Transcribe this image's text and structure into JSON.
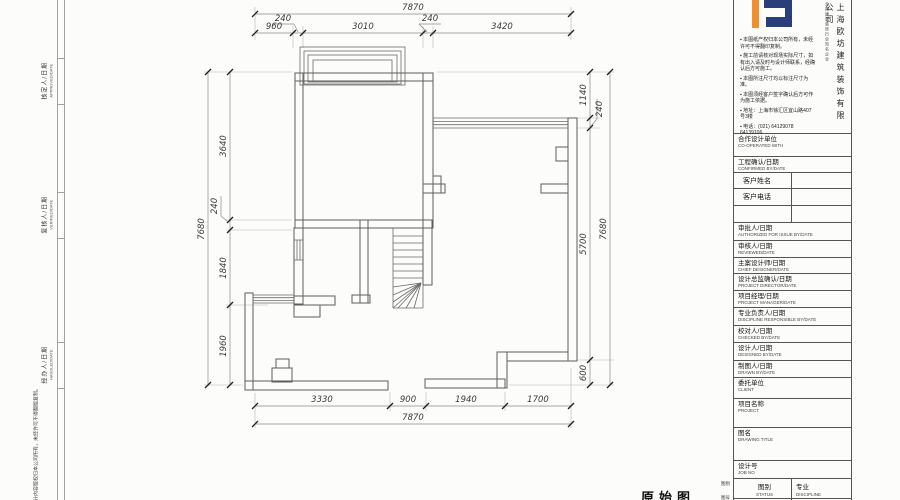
{
  "drawing": {
    "caption": "原始图"
  },
  "border": {
    "labels": [
      {
        "cn": "核定人/日期",
        "en": "APPROVED/DATE"
      },
      {
        "cn": "复核人/日期",
        "en": "VERIFIED/DATE"
      },
      {
        "cn": "经办人/日期",
        "en": "HANDLED/DATE"
      }
    ],
    "copyright": "本图纸设计内容版权归本公司所有，未经许可不得翻版复制。",
    "outside_labels": [
      "图别",
      "图号"
    ]
  },
  "titleblock": {
    "company": "上海欧坊建筑装饰有限公司",
    "tagline": "全国建筑装饰行业知名企业",
    "brand_navy": "#2b3e7c",
    "brand_orange": "#ef8f2f",
    "notes": [
      "▪ 本图纸产权归本公司所有，未经许可不得翻印复制。",
      "▪ 施工前请核对现场实际尺寸，如有出入请及时与设计师联系，经确认后方可施工。",
      "▪ 本图所注尺寸均以标注尺寸为准。",
      "▪ 本图须经客户签字确认后方可作为施工依据。",
      "▪ 地址：上海市徐汇区宜山路407号3楼",
      "▪ 电话：(021) 64129078  64139106"
    ],
    "rows": [
      {
        "cn": "合作设计单位",
        "en": "CO-OPERATED WITH"
      },
      {
        "cn": "工程确认/日期",
        "en": "CONFIRMED BY/DATE"
      },
      {
        "cn": "客户姓名",
        "en": ""
      },
      {
        "cn": "客户电话",
        "en": ""
      },
      {
        "cn": "",
        "en": ""
      },
      {
        "cn": "审批人/日期",
        "en": "AUTHORIZED FOR ISSUE BY/DATE"
      },
      {
        "cn": "审核人/日期",
        "en": "REVIEWED/DATE"
      },
      {
        "cn": "主案设计师/日期",
        "en": "CHIEF DESIGNER/DATE"
      },
      {
        "cn": "设计总监确认/日期",
        "en": "PROJECT DIRECTOR/DATE"
      },
      {
        "cn": "项目经理/日期",
        "en": "PROJECT MANAGER/DATE"
      },
      {
        "cn": "专业负责人/日期",
        "en": "DISCIPLINE RESPONSIBLE BY/DATE"
      },
      {
        "cn": "校对人/日期",
        "en": "CHECKED BY/DATE"
      },
      {
        "cn": "设计人/日期",
        "en": "DESIGNED BY/DATE"
      },
      {
        "cn": "制图人/日期",
        "en": "DRAWN BY/DATE"
      },
      {
        "cn": "委托单位",
        "en": "CLIENT"
      },
      {
        "cn": "项目名称",
        "en": "PROJECT"
      },
      {
        "cn": "图名",
        "en": "DRAWING TITLE"
      },
      {
        "cn": "设计号",
        "en": "JOB NO"
      }
    ],
    "bottom": {
      "left_cn": "图别",
      "left_en": "STATUS",
      "right_cn": "专业",
      "right_en": "DISCIPLINE"
    }
  },
  "plan_geometry": {
    "walls": [
      [
        295,
        73,
        138,
        8
      ],
      [
        295,
        73,
        8,
        155
      ],
      [
        423,
        73,
        10,
        155
      ],
      [
        295,
        220,
        137,
        8
      ],
      [
        360,
        220,
        8,
        83
      ],
      [
        352,
        295,
        18,
        8
      ],
      [
        423,
        228,
        9,
        57
      ],
      [
        245,
        293,
        8,
        97
      ],
      [
        245,
        381,
        143,
        9
      ],
      [
        294,
        228,
        9,
        76
      ],
      [
        294,
        296,
        41,
        9
      ],
      [
        294,
        305,
        26,
        12
      ],
      [
        276,
        359,
        13,
        9
      ],
      [
        272,
        368,
        20,
        14
      ],
      [
        425,
        379,
        80,
        9
      ],
      [
        497,
        352,
        10,
        36
      ],
      [
        507,
        352,
        61,
        9
      ],
      [
        568,
        118,
        9,
        243
      ],
      [
        433,
        176,
        8,
        17
      ],
      [
        556,
        147,
        12,
        14
      ],
      [
        541,
        184,
        27,
        9
      ],
      [
        423,
        184,
        22,
        9
      ]
    ],
    "bay": [
      [
        300,
        47,
        105,
        38
      ],
      [
        304,
        51,
        97,
        33
      ],
      [
        308,
        55,
        89,
        27
      ],
      [
        313,
        60,
        79,
        21
      ]
    ],
    "lines": [
      [
        433,
        118,
        568,
        118
      ],
      [
        433,
        121.4,
        568,
        121.4
      ],
      [
        433,
        124.7,
        568,
        124.7
      ],
      [
        433,
        128,
        568,
        128
      ],
      [
        253,
        295,
        294,
        295
      ],
      [
        253,
        297.7,
        294,
        297.7
      ],
      [
        253,
        300.4,
        294,
        300.4
      ],
      [
        253,
        303,
        294,
        303
      ],
      [
        253,
        295,
        253,
        303
      ],
      [
        294,
        240,
        303,
        240
      ],
      [
        294,
        260,
        303,
        260
      ],
      [
        297,
        240,
        297,
        260
      ],
      [
        300,
        240,
        300,
        260
      ],
      [
        393,
        228,
        393,
        308
      ],
      [
        423,
        285,
        423,
        308
      ],
      [
        393,
        308,
        423,
        308
      ],
      [
        393,
        236,
        423,
        236
      ],
      [
        393,
        243,
        423,
        243
      ],
      [
        393,
        250,
        423,
        250
      ],
      [
        393,
        257,
        423,
        257
      ],
      [
        393,
        264,
        423,
        264
      ],
      [
        393,
        271,
        423,
        271
      ],
      [
        393,
        278,
        423,
        278
      ],
      [
        421,
        283,
        393,
        287
      ],
      [
        421,
        283,
        393,
        295
      ],
      [
        421,
        283,
        393,
        302
      ],
      [
        421,
        283,
        398,
        308
      ],
      [
        421,
        283,
        406,
        308
      ],
      [
        421,
        283,
        414,
        308
      ],
      [
        421,
        283,
        393,
        308
      ]
    ],
    "ext": [
      [
        255,
        7,
        255,
        40
      ],
      [
        571,
        7,
        571,
        40
      ],
      [
        293,
        26,
        293,
        48
      ],
      [
        303,
        26,
        303,
        48
      ],
      [
        423,
        26,
        423,
        48
      ],
      [
        433,
        26,
        433,
        48
      ],
      [
        204,
        72,
        292,
        72
      ],
      [
        226,
        220,
        292,
        220
      ],
      [
        226,
        230,
        292,
        230
      ],
      [
        226,
        305,
        268,
        305
      ],
      [
        204,
        385,
        243,
        385
      ],
      [
        437,
        72,
        614,
        72
      ],
      [
        577,
        118,
        600,
        118
      ],
      [
        577,
        128,
        600,
        128
      ],
      [
        577,
        360,
        614,
        360
      ],
      [
        509,
        385,
        614,
        385
      ],
      [
        255,
        393,
        255,
        428
      ],
      [
        571,
        368,
        571,
        428
      ],
      [
        390,
        392,
        390,
        411
      ],
      [
        426,
        392,
        426,
        411
      ],
      [
        505,
        392,
        505,
        411
      ]
    ],
    "leaders": [
      [
        272,
        24,
        294,
        24
      ],
      [
        294,
        24,
        298,
        32
      ],
      [
        419,
        24,
        441,
        24
      ],
      [
        419,
        24,
        427,
        32
      ],
      [
        221,
        196,
        221,
        216
      ],
      [
        221,
        216,
        228,
        222
      ],
      [
        597,
        99,
        597,
        119
      ],
      [
        597,
        119,
        591,
        126
      ]
    ],
    "dimlines": [
      {
        "o": "h",
        "pos": 14,
        "from": 255,
        "to": 571,
        "ticks": [
          255,
          571
        ]
      },
      {
        "o": "h",
        "pos": 33,
        "from": 255,
        "to": 571,
        "ticks": [
          255,
          293,
          303,
          423,
          433,
          571
        ]
      },
      {
        "o": "v",
        "pos": 230,
        "from": 72,
        "to": 385,
        "ticks": [
          72,
          220,
          230,
          305,
          385
        ]
      },
      {
        "o": "v",
        "pos": 208,
        "from": 72,
        "to": 385,
        "ticks": [
          72,
          385
        ]
      },
      {
        "o": "v",
        "pos": 590,
        "from": 72,
        "to": 385,
        "ticks": [
          72,
          118,
          128,
          360,
          385
        ]
      },
      {
        "o": "v",
        "pos": 610,
        "from": 72,
        "to": 385,
        "ticks": [
          72,
          385
        ]
      },
      {
        "o": "h",
        "pos": 406,
        "from": 255,
        "to": 571,
        "ticks": [
          255,
          390,
          426,
          505,
          571
        ]
      },
      {
        "o": "h",
        "pos": 424,
        "from": 255,
        "to": 571,
        "ticks": [
          255,
          571
        ]
      }
    ],
    "labels": [
      {
        "t": "7870",
        "x": 413,
        "y": 10
      },
      {
        "t": "960",
        "x": 274,
        "y": 29
      },
      {
        "t": "240",
        "x": 283,
        "y": 21
      },
      {
        "t": "3010",
        "x": 363,
        "y": 29
      },
      {
        "t": "240",
        "x": 430,
        "y": 21
      },
      {
        "t": "3420",
        "x": 502,
        "y": 29
      },
      {
        "t": "3640",
        "x": 226,
        "y": 146,
        "r": 1
      },
      {
        "t": "240",
        "x": 217,
        "y": 206,
        "r": 1
      },
      {
        "t": "1840",
        "x": 226,
        "y": 268,
        "r": 1
      },
      {
        "t": "1960",
        "x": 226,
        "y": 346,
        "r": 1
      },
      {
        "t": "7680",
        "x": 204,
        "y": 229,
        "r": 1
      },
      {
        "t": "1140",
        "x": 586,
        "y": 95,
        "r": 1
      },
      {
        "t": "240",
        "x": 602,
        "y": 109,
        "r": 1
      },
      {
        "t": "5700",
        "x": 586,
        "y": 244,
        "r": 1
      },
      {
        "t": "600",
        "x": 586,
        "y": 373,
        "r": 1
      },
      {
        "t": "7680",
        "x": 606,
        "y": 229,
        "r": 1
      },
      {
        "t": "3330",
        "x": 322,
        "y": 402
      },
      {
        "t": "900",
        "x": 408,
        "y": 402
      },
      {
        "t": "1940",
        "x": 466,
        "y": 402
      },
      {
        "t": "1700",
        "x": 538,
        "y": 402
      },
      {
        "t": "7870",
        "x": 413,
        "y": 420
      }
    ]
  }
}
